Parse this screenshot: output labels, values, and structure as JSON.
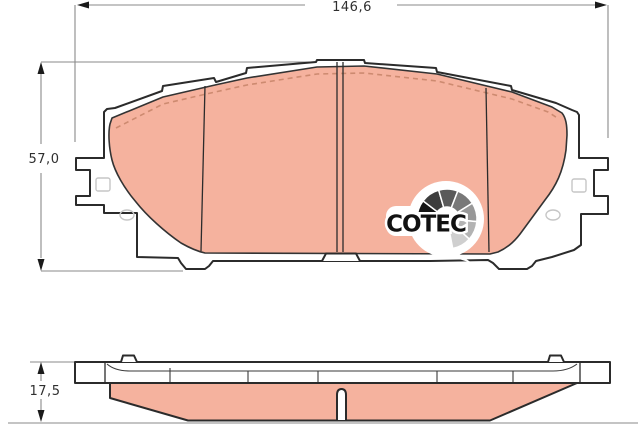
{
  "drawing": {
    "title": "Brake pad technical drawing",
    "dimensions": {
      "width_label": "146,6",
      "height_label": "57,0",
      "thickness_label": "17,5"
    },
    "logo": {
      "text": "COTEC"
    },
    "colors": {
      "friction": "#f5b29e",
      "outline": "#2b2b2b",
      "dimension_line": "#8a8a8a",
      "chamfer_dash": "#cd8a70",
      "faint_detail": "#c6c6c6",
      "fan_segments": [
        "#151515",
        "#3d3d3d",
        "#5a5a5a",
        "#787878",
        "#989898",
        "#b3b3b3",
        "#cfcfcf"
      ]
    }
  }
}
